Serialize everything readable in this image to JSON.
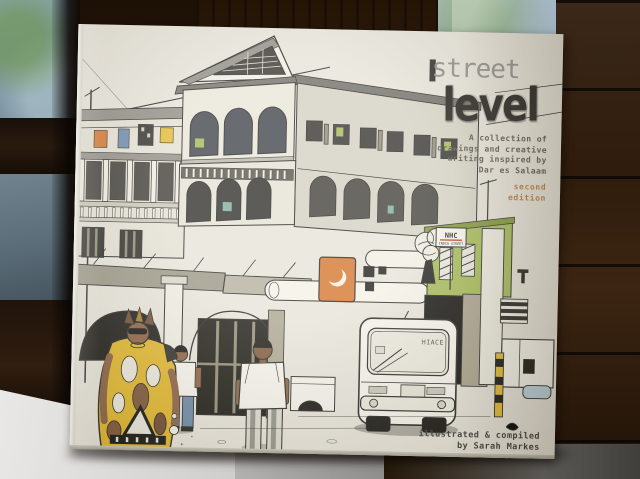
{
  "book_cover": {
    "background_color": "#e7e3d8",
    "title": {
      "word1": "street",
      "word2": "level",
      "word1_color": "#8e8d88",
      "word2_color": "#1d1c17"
    },
    "subtitle_lines": [
      "A collection of",
      "drawings and creative",
      "writing inspired by",
      "Dar es Salaam"
    ],
    "edition_lines": [
      "second",
      "edition"
    ],
    "edition_color": "#b5763c",
    "credit_lines": [
      "illustrated & compiled",
      "by Sarah Markes"
    ],
    "illustration": {
      "van_label": "HIACE",
      "sign_lines": [
        "NHC",
        "INDIA STREET"
      ],
      "palette": {
        "ink": "#262520",
        "khaki": "#a9a38c",
        "olive_green": "#a3b954",
        "orange": "#d4752a",
        "yellow": "#e0b52a",
        "denim_blue": "#6a87a6",
        "teal": "#7fae9e",
        "skin_brown": "#8a5f3f"
      }
    }
  },
  "photo_background": {
    "window_glass": "#8ca6b3",
    "foliage_green": "#6e9650",
    "wood_dark": "#2b1a0b",
    "table_light": "#dcdbd9"
  }
}
